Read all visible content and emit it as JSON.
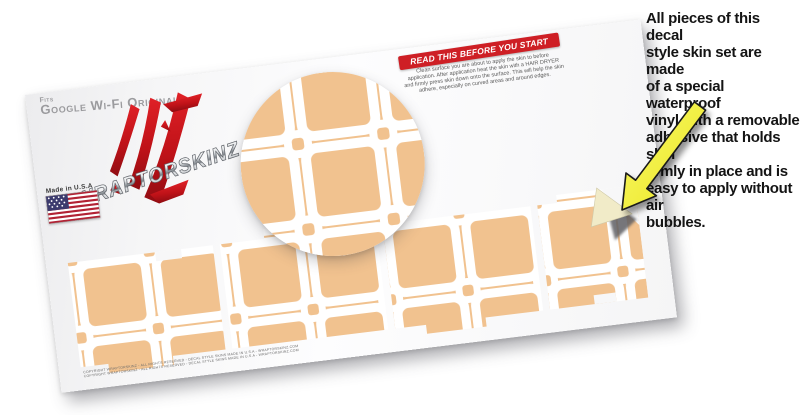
{
  "sheet": {
    "fits_label": "Fits",
    "device_label": "Google Wi-Fi Original",
    "brand": "WRAPTORSKINZ",
    "made_in": "Made in U.S.A",
    "banner_label": "READ THIS BEFORE YOU START",
    "instructions_lines": [
      "Clean surface you are about to apply the skin to before",
      "application. After application heat the skin with a HAIR DRYER",
      "and firmly press skin down onto the surface. This will help the skin",
      "adhere, especially on curved areas and around edges."
    ],
    "fine_print": "COPYRIGHT WRAPTORSKINZ - ALL RIGHTS RESERVED - DECAL STYLE SKINS MADE IN U.S.A - WRAPTORSKINZ.COM"
  },
  "callout_lines": [
    "All pieces of this decal",
    "style  skin set are made",
    "of a special waterproof",
    "vinyl with a removable",
    "adhesive that holds skin",
    "firmly in place and is",
    "easy to apply without air",
    "bubbles."
  ],
  "colors": {
    "pattern_tan": "#F1C28F",
    "pattern_line": "#FFFFFF",
    "banner_red": "#CE1F25",
    "claw_red": "#C01218",
    "arrow_yellow": "#F2EF3C",
    "peel_back_cream": "#F1EBC8"
  },
  "icons": {
    "flag": "us-flag-icon",
    "arrow": "peel-corner-arrow"
  }
}
